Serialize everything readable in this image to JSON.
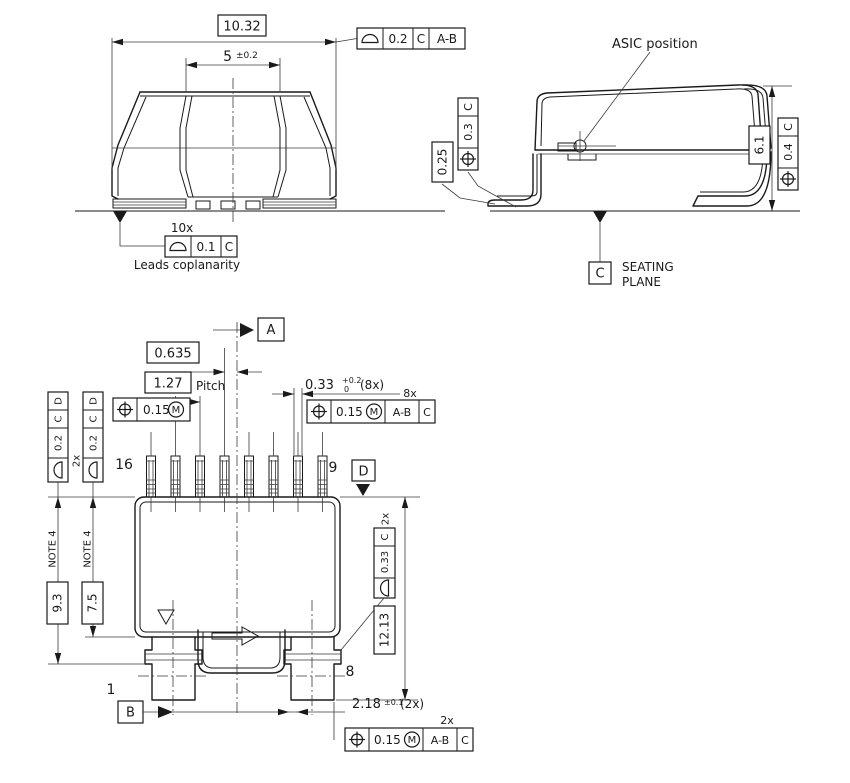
{
  "front_view": {
    "dim_overall": "10.32",
    "dim_center": "5",
    "dim_center_tol": "±0.2",
    "fcf_profile_top": {
      "symbol": "profile-of-surface",
      "value": "0.2",
      "ref1": "C",
      "ref2": "A-B"
    },
    "leads_count": "10x",
    "fcf_coplanarity": {
      "symbol": "profile-of-surface",
      "value": "0.1",
      "ref1": "C"
    },
    "coplanarity_caption": "Leads coplanarity"
  },
  "side_view": {
    "asic_callout": "ASIC position",
    "dim_standoff": "0.25",
    "fcf_position_left": {
      "symbol": "position",
      "value": "0.3",
      "ref1": "C"
    },
    "dim_height": "6.1",
    "fcf_position_right": {
      "symbol": "position",
      "value": "0.4",
      "ref1": "C"
    },
    "seating_line1": "SEATING",
    "seating_line2": "PLANE",
    "datum_c": "C"
  },
  "bottom_view": {
    "datum_a": "A",
    "datum_b": "B",
    "datum_d": "D",
    "dim_offset": "0.635",
    "dim_pitch": "1.27",
    "pitch_caption": "Pitch",
    "fcf_pitch": {
      "symbol": "position",
      "value": "0.15",
      "modifier": "M"
    },
    "dim_lead_width": "0.33",
    "dim_lead_width_tol_upper": "+0.2",
    "dim_lead_width_tol_lower": "0",
    "dim_lead_width_qty": "(8x)",
    "qty_8x": "8x",
    "fcf_leads": {
      "symbol": "position",
      "value": "0.15",
      "modifier": "M",
      "ref1": "A-B",
      "ref2": "C"
    },
    "fcf_profile_left_1": {
      "symbol": "profile-of-surface",
      "value": "0.2",
      "ref1": "C",
      "ref2": "D"
    },
    "fcf_profile_left_2": {
      "symbol": "profile-of-surface",
      "value": "0.2",
      "ref1": "C",
      "ref2": "D"
    },
    "qty_2x_left": "2x",
    "pin_16": "16",
    "pin_9": "9",
    "pin_1": "1",
    "pin_8": "8",
    "note_left_1": "NOTE 4",
    "note_left_2": "NOTE 4",
    "dim_body_len_1": "9.3",
    "dim_body_len_2": "7.5",
    "fcf_profile_tab": {
      "symbol": "profile-of-surface",
      "value": "0.33",
      "ref1": "C"
    },
    "qty_2x_tab": "2x",
    "dim_overall_len": "12.13",
    "dim_tab": "2.18",
    "dim_tab_tol": "±0.1",
    "dim_tab_qty": "(2x)",
    "qty_2x_bottom": "2x",
    "fcf_position_bottom": {
      "symbol": "position",
      "value": "0.15",
      "modifier": "M",
      "ref1": "A-B",
      "ref2": "C"
    }
  }
}
